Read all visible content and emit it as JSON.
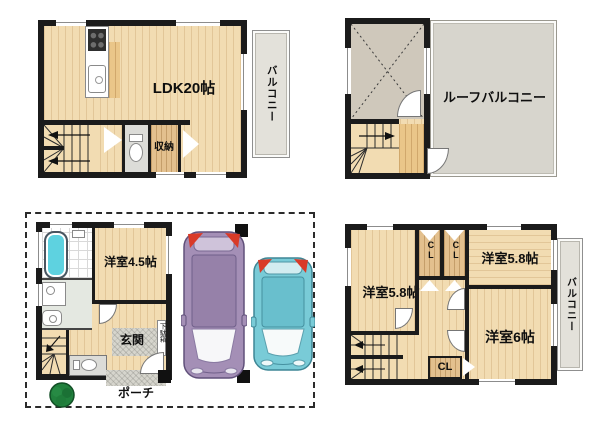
{
  "plan_ldk_floor": {
    "ldk_label": "LDK20帖",
    "storage_label": "収納",
    "balcony_label": "バルコニー"
  },
  "plan_roof_floor": {
    "roof_balcony_label": "ルーフバルコニー"
  },
  "plan_ground_floor": {
    "bedroom_label": "洋室4.5帖",
    "entrance_label": "玄関",
    "shoe_cabinet_label": "下駄箱",
    "porch_label": "ポーチ"
  },
  "plan_bedroom_floor": {
    "bedroom_left_label": "洋室5.8帖",
    "bedroom_right_label": "洋室5.8帖",
    "bedroom_bottom_label": "洋室6帖",
    "closet_top_left_label": "CL",
    "closet_top_right_label": "CL",
    "closet_bottom_label": "CL",
    "balcony_label": "バルコニー"
  },
  "colors": {
    "wall": "#1b1b1b",
    "wood_floor": "#f2dcb2",
    "balcony": "#e3e1da",
    "roof_balcony": "#d7d5cd",
    "bathtub": "#5ed2e0",
    "car_large": "#a48fb6",
    "car_small": "#79cbd7",
    "tail_light": "#d93a28",
    "tree": "#21813d"
  }
}
